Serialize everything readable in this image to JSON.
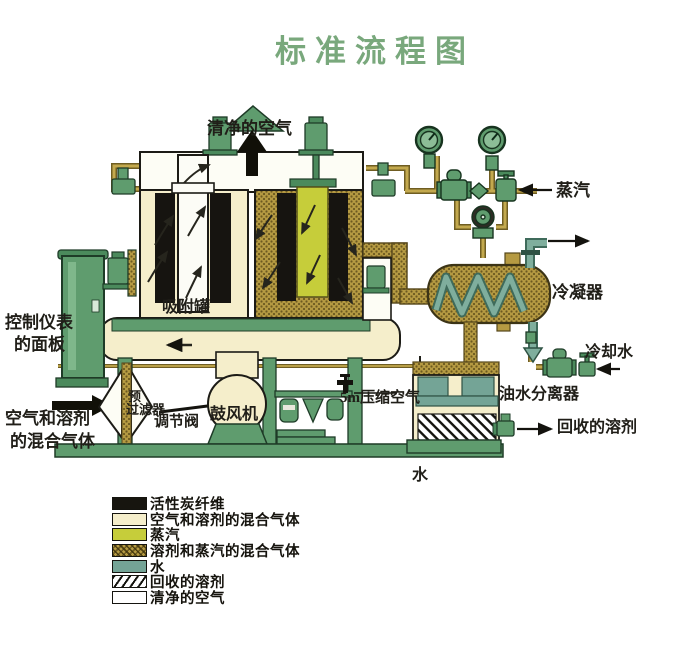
{
  "title": "标准流程图",
  "colors": {
    "title_green": "#79a87c",
    "equipment_green": "#5f9c6e",
    "mixture_cream": "#f5eecb",
    "steam_yellow": "#c6cd3a",
    "solvent_steam_khaki": "#b59a42",
    "water_teal": "#74a496",
    "carbon_black": "#17150f"
  },
  "labels": {
    "clean_air": "清净的空气",
    "steam": "蒸汽",
    "condenser": "冷凝器",
    "cooling_water": "冷却水",
    "oil_water_separator": "油水分离器",
    "recovered_solvent": "回收的溶剂",
    "control_panel_line1": "控制仪表",
    "control_panel_line2": "的面板",
    "inlet_line1": "空气和溶剂",
    "inlet_line2": "的混合气体",
    "adsorber": "吸附罐",
    "prefilter_line1": "预",
    "prefilter_line2": "过滤器",
    "regulating_valve": "调节阀",
    "blower": "鼓风机",
    "compressed_air": "5m压缩空气",
    "water": "水"
  },
  "legend": {
    "items": [
      {
        "label": "活性炭纤维",
        "swatch": "black"
      },
      {
        "label": "空气和溶剂的混合气体",
        "swatch": "cream"
      },
      {
        "label": "蒸汽",
        "swatch": "steam-yellow"
      },
      {
        "label": "溶剂和蒸汽的混合气体",
        "swatch": "khaki-hatch"
      },
      {
        "label": "水",
        "swatch": "teal"
      },
      {
        "label": "回收的溶剂",
        "swatch": "diag-hatch"
      },
      {
        "label": "清净的空气",
        "swatch": "white"
      }
    ]
  }
}
